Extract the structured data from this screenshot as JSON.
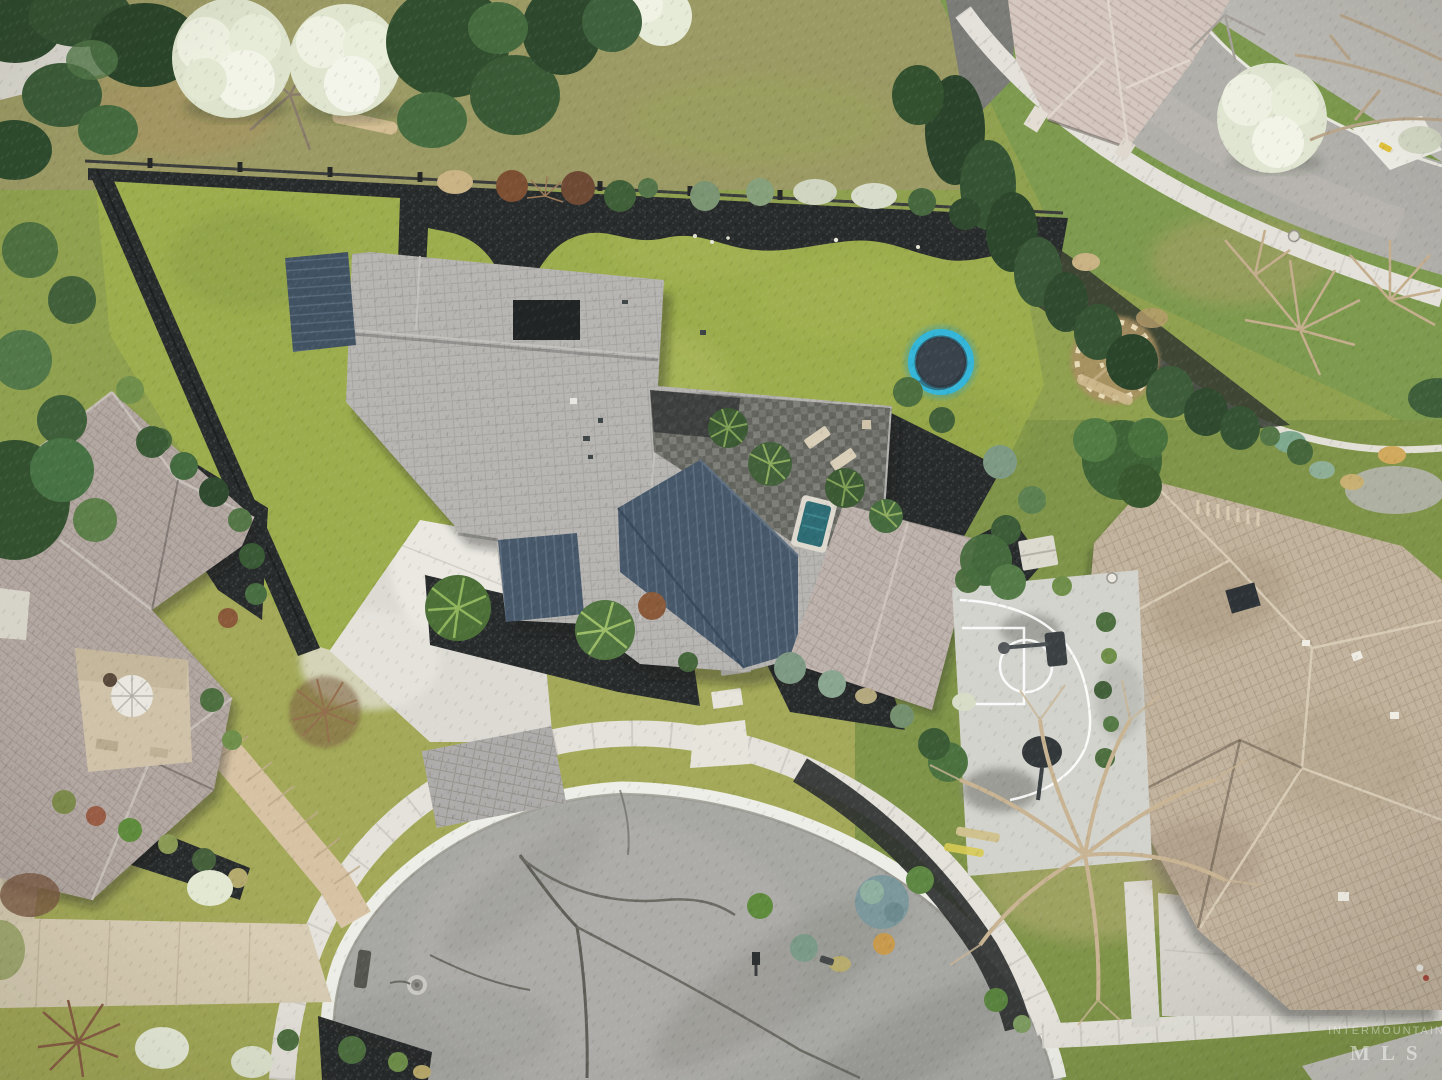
{
  "watermark": {
    "line1": "INTERMOUNTAIN",
    "line2": "MLS"
  },
  "scene": {
    "description": "Aerial drone view of a modern single-story home with a large landscaped backyard, sunken trampoline, back patio with hot tub, concrete driveway to a cul-de-sac, neighboring houses, basketball court, winding garden path and mature trees",
    "objects": [
      "main-house",
      "left-house",
      "right-house",
      "top-right-house",
      "street",
      "cul-de-sac",
      "sidewalk-ring",
      "driveway",
      "paver-apron",
      "backyard-lawn",
      "front-lawn",
      "mulch-border",
      "trampoline",
      "back-patio",
      "hot-tub",
      "lounge-chairs",
      "basketball-court",
      "basketball-hoop",
      "stone-circle-garden",
      "garden-path",
      "stepping-stones",
      "walkways",
      "flowering-trees",
      "evergreen-trees",
      "bare-trees",
      "manhole-cover",
      "mailbox"
    ]
  },
  "palette": {
    "lawn_bright": "#9cad4d",
    "lawn_front": "#a4aa58",
    "lawn_right": "#7f9449",
    "grass_dry": "#b3a96c",
    "mulch_dark": "#2a2d2d",
    "asphalt_culdesac": "#a7a7a3",
    "asphalt_road": "#b1afaa",
    "concrete_driveway": "#dcdad3",
    "sidewalk": "#e4e2da",
    "walkway_tan": "#d8cdb4",
    "roof_shingle_gray": "#b7b5b2",
    "roof_metal_slate": "#475868",
    "roof_left_house": "#b2a7a1",
    "roof_right_house": "#c2b39e",
    "roof_top_right_house": "#d4c7bf",
    "trampoline_ring": "#35b6d8",
    "trampoline_mat": "#3a434c",
    "hot_tub_water": "#2e6d75",
    "court_concrete": "#d2d3cd",
    "court_lines": "#ffffff",
    "tree_dark_green": "#2f4a2e",
    "tree_flowering_white": "#e9ecdc",
    "shrub_blue_green": "#7e9a84",
    "bare_branches": "#c4ae8e"
  }
}
